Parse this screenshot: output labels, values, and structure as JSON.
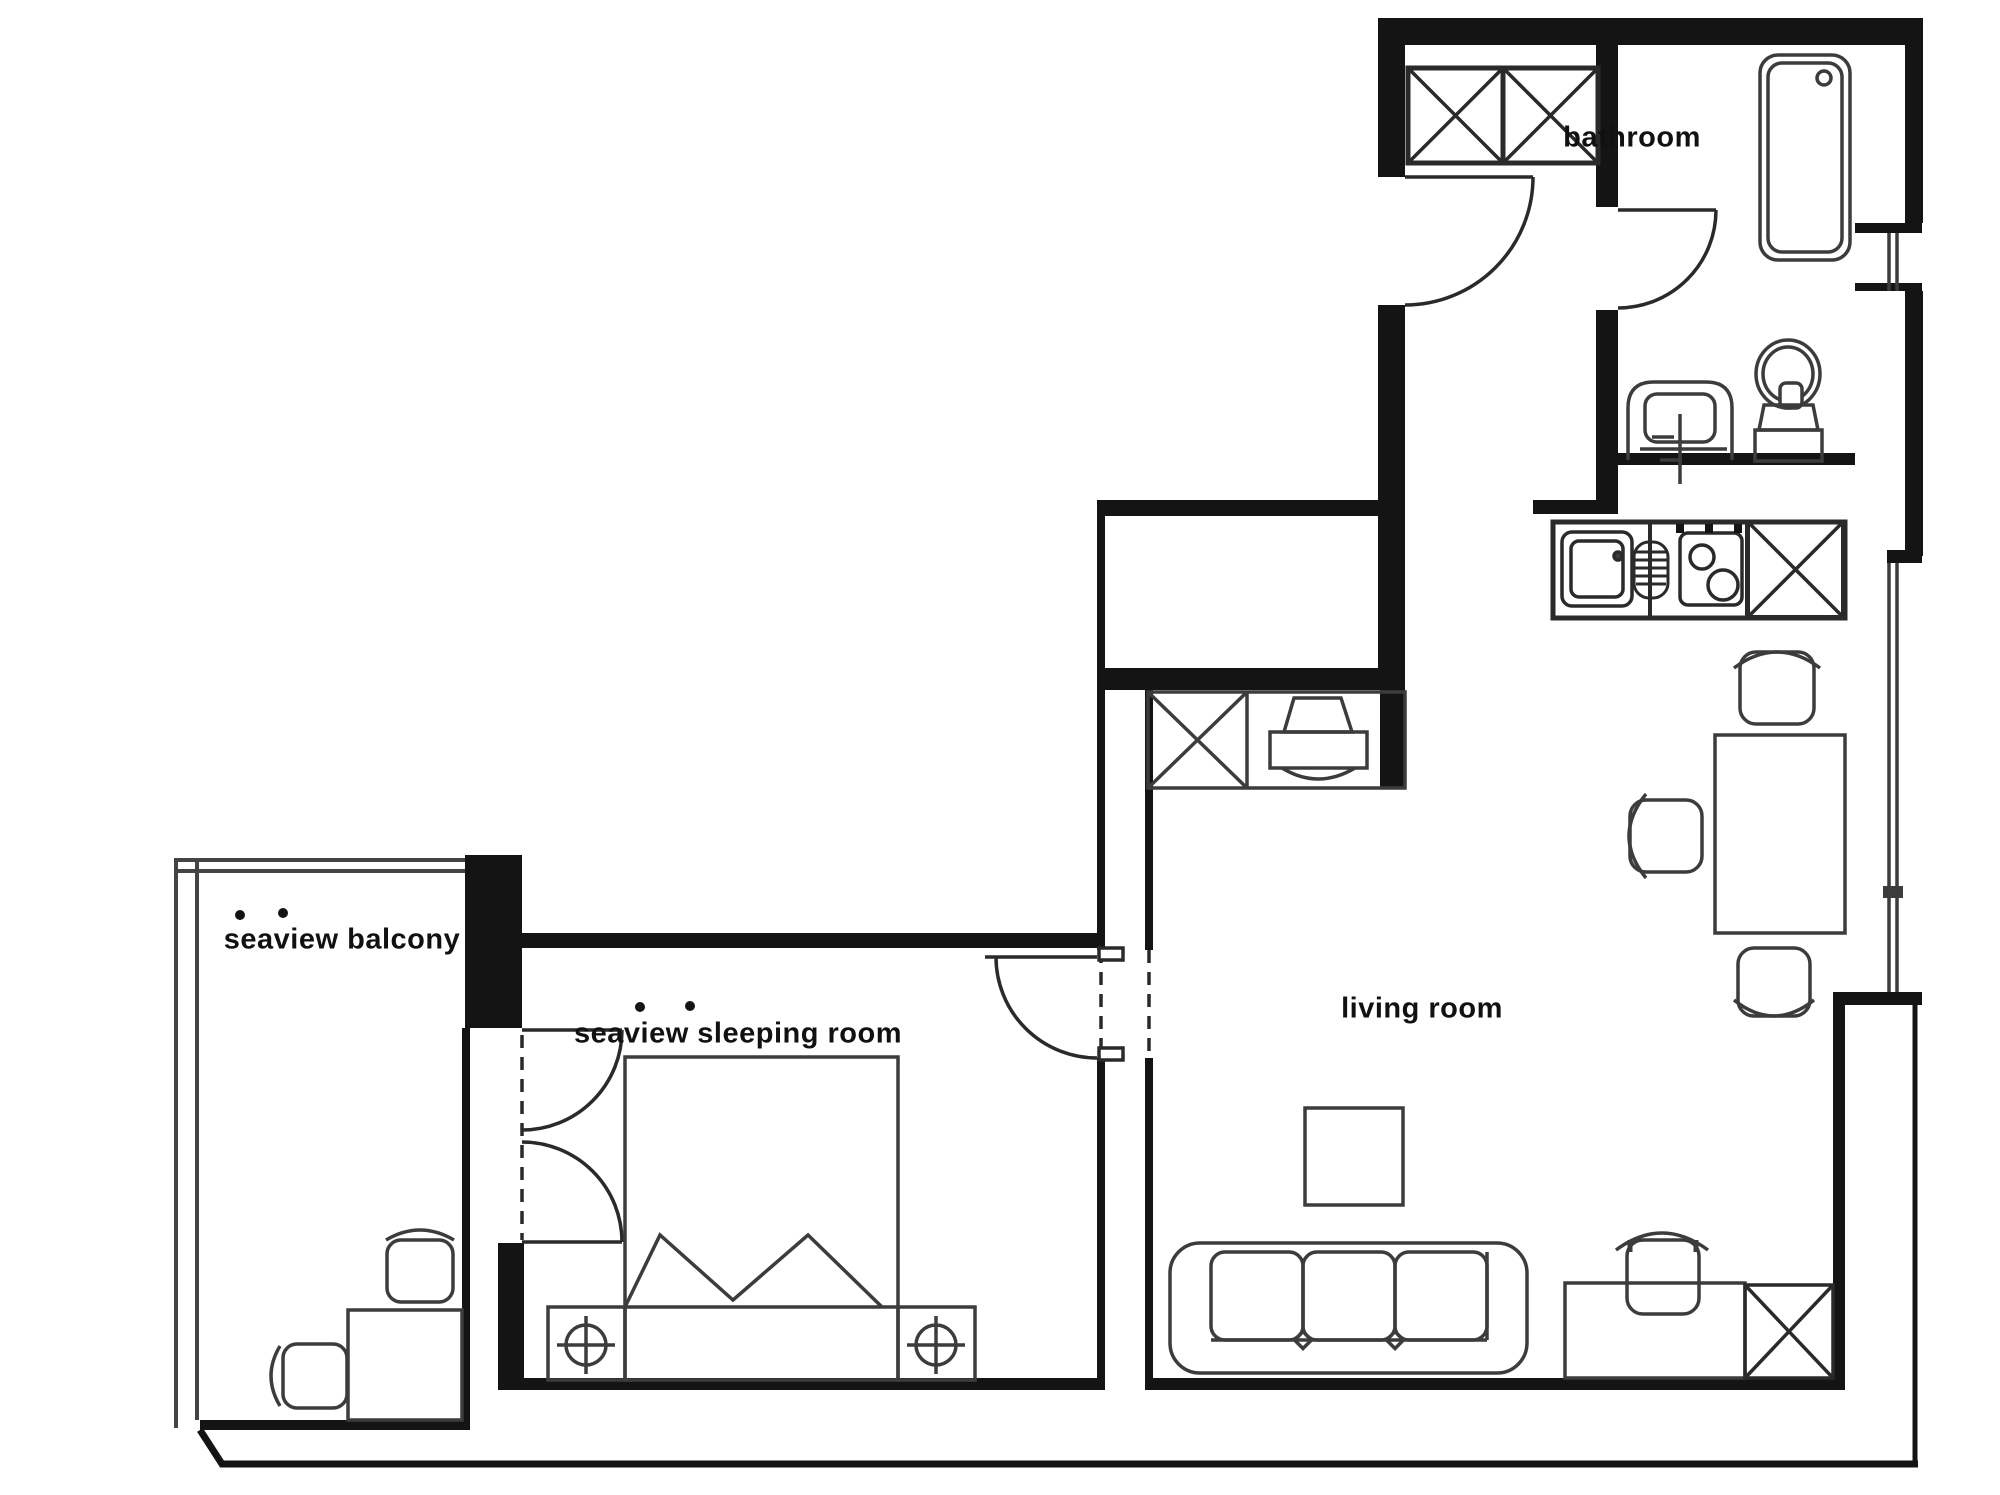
{
  "title": "apartment floor plan",
  "colors": {
    "background": "#ffffff",
    "wall": "#141414",
    "furniture_line": "#3c3c3c",
    "thin_line": "#555555"
  },
  "rooms": {
    "bathroom": {
      "label": "bathroom"
    },
    "balcony": {
      "label": "seaview balcony"
    },
    "sleeping": {
      "label": "seaview sleeping room"
    },
    "living": {
      "label": "living room"
    }
  },
  "icons": {
    "closet": "crossed-box-icon",
    "bathtub": "bathtub-icon",
    "toilet": "toilet-icon",
    "bathroom_sink": "washbasin-icon",
    "kitchen_sink": "kitchen-sink-icon",
    "drainer": "drainer-icon",
    "stove": "two-burner-stove-icon",
    "fridge_cabinet": "crossed-box-icon",
    "dining_table": "table-icon",
    "chair": "chair-icon",
    "computer_desk": "computer-workstation-icon",
    "sofa": "three-seat-sofa-icon",
    "coffee_table": "coffee-table-icon",
    "desk": "desk-icon",
    "bed": "double-bed-icon",
    "nightstand_lamp": "bedside-lamp-icon",
    "door": "door-swing-icon",
    "window": "window-icon",
    "balcony_rail": "railing-icon"
  }
}
